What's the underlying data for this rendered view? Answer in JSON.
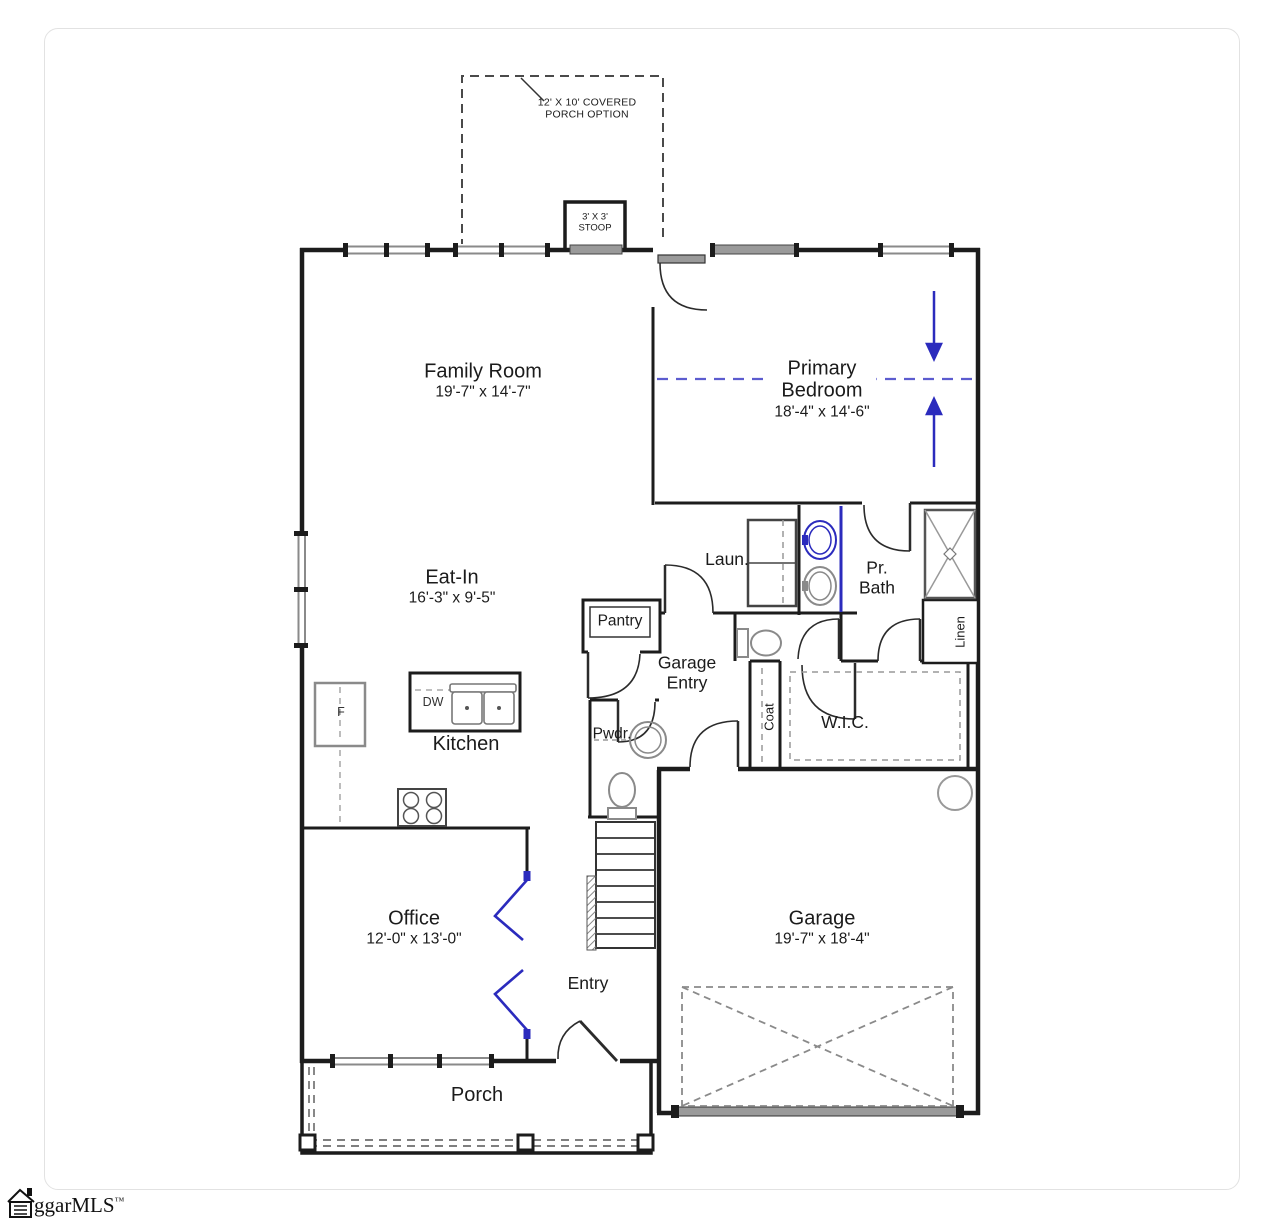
{
  "annotations": {
    "covered_porch": {
      "line1": "12' X 10' COVERED",
      "line2": "PORCH OPTION"
    },
    "stoop": {
      "line1": "3' X 3'",
      "line2": "STOOP"
    }
  },
  "rooms": {
    "family_room": {
      "name": "Family Room",
      "dims": "19'-7\" x 14'-7\""
    },
    "primary_bedroom": {
      "name1": "Primary",
      "name2": "Bedroom",
      "dims": "18'-4\" x 14'-6\""
    },
    "eat_in": {
      "name": "Eat-In",
      "dims": "16'-3\" x 9'-5\""
    },
    "laundry": {
      "name": "Laun."
    },
    "primary_bath": {
      "name1": "Pr.",
      "name2": "Bath"
    },
    "pantry": {
      "name": "Pantry"
    },
    "garage_entry": {
      "name1": "Garage",
      "name2": "Entry"
    },
    "powder": {
      "name": "Pwdr."
    },
    "coat": {
      "name": "Coat"
    },
    "wic": {
      "name": "W.I.C."
    },
    "linen": {
      "name": "Linen"
    },
    "kitchen": {
      "name": "Kitchen"
    },
    "office": {
      "name": "Office",
      "dims": "12'-0\" x 13'-0\""
    },
    "entry": {
      "name": "Entry"
    },
    "garage": {
      "name": "Garage",
      "dims": "19'-7\" x 18'-4\""
    },
    "porch": {
      "name": "Porch"
    }
  },
  "appliances": {
    "fridge": "F",
    "dishwasher": "DW"
  },
  "watermark": {
    "brand": "ggarMLS",
    "tm": "™"
  },
  "colors": {
    "wall": "#1c1c1c",
    "accent_blue": "#2b2bbd",
    "window_gray": "#8a8a8a"
  }
}
